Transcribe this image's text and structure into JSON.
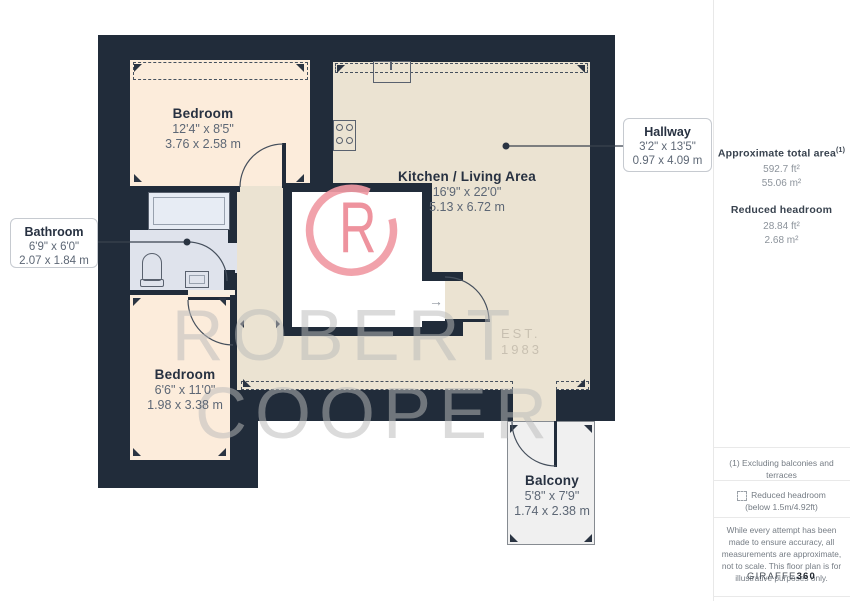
{
  "plan": {
    "rooms": [
      {
        "name": "Bedroom",
        "imperial": "12'4\" x 8'5\"",
        "metric": "3.76 x 2.58 m"
      },
      {
        "name": "Kitchen / Living Area",
        "imperial": "16'9\" x 22'0\"",
        "metric": "5.13 x 6.72 m"
      },
      {
        "name": "Bedroom",
        "imperial": "6'6\" x 11'0\"",
        "metric": "1.98 x 3.38 m"
      },
      {
        "name": "Balcony",
        "imperial": "5'8\" x 7'9\"",
        "metric": "1.74 x 2.38 m"
      }
    ],
    "callouts": [
      {
        "name": "Bathroom",
        "imperial": "6'9\" x 6'0\"",
        "metric": "2.07 x 1.84 m"
      },
      {
        "name": "Hallway",
        "imperial": "3'2\" x 13'5\"",
        "metric": "0.97 x 4.09 m"
      }
    ],
    "entrance_arrow": "→"
  },
  "watermark": {
    "brand_line1": "ROBERT",
    "brand_line2": "COOPER",
    "est_label": "EST.",
    "est_year": "1983",
    "monogram_letter": "R"
  },
  "sidebar": {
    "total_area_label": "Approximate total area",
    "total_area_sup": "(1)",
    "total_area_ft": "592.7 ft²",
    "total_area_m": "55.06 m²",
    "headroom_label": "Reduced headroom",
    "headroom_ft": "28.84 ft²",
    "headroom_m": "2.68 m²",
    "note1": "(1) Excluding balconies and terraces",
    "legend_label": "Reduced headroom",
    "legend_sub": "(below 1.5m/4.92ft)",
    "disclaimer": "While every attempt has been made to ensure accuracy, all measurements are approximate, not to scale. This floor plan is for illustrative purposes only.",
    "brand": "GIRAFFE",
    "brand_bold": "360"
  },
  "colors": {
    "wall": "#212c3a",
    "bedroom_fill": "#fcecdb",
    "kitchen_fill": "#ebe3d2",
    "bathroom_fill": "#dfe3ec",
    "balcony_fill": "#f0f0f0",
    "watermark_pink": "#f09aa4",
    "label_text": "#273141"
  }
}
